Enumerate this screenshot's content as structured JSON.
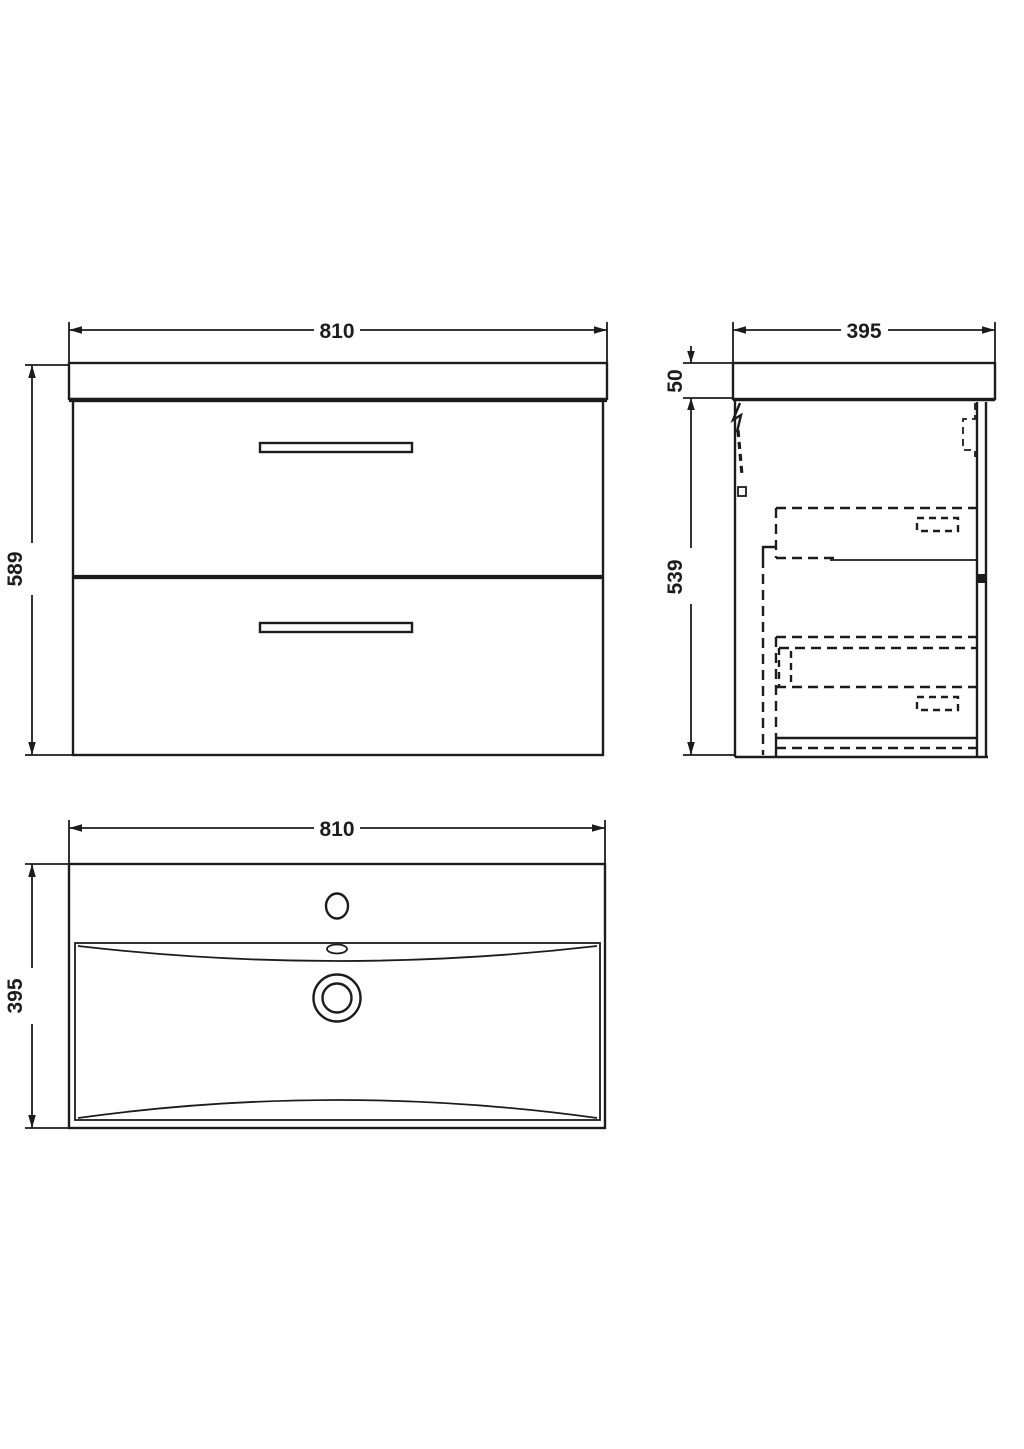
{
  "page": {
    "background": "#ffffff",
    "line_color": "#1c1c1c"
  },
  "drawing": {
    "views": {
      "front": {
        "width_label": "810",
        "height_label": "589"
      },
      "side": {
        "width_label": "395",
        "worktop_height_label": "50",
        "cabinet_height_label": "539"
      },
      "plan": {
        "width_label": "810",
        "depth_label": "395"
      }
    }
  }
}
